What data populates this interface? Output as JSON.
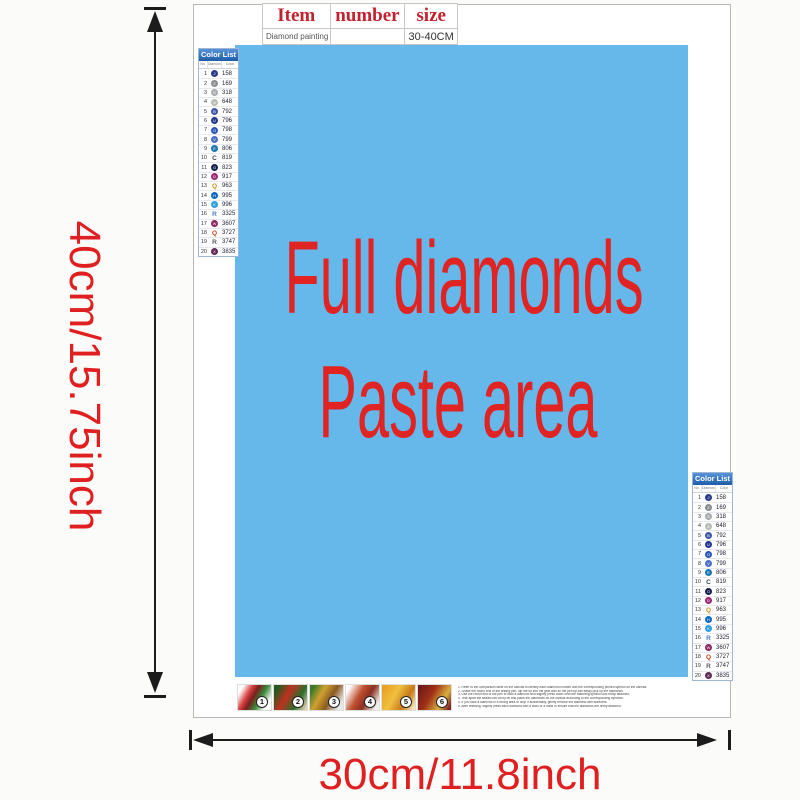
{
  "title_table": {
    "headers": [
      "Item",
      "number",
      "size"
    ],
    "item_value": "Diamond painting",
    "number_value": "",
    "size_value": "30-40CM"
  },
  "paste_area": {
    "line1": "Full diamonds",
    "line2": "Paste area",
    "bg_color": "#65b8e9",
    "text_color": "#e02424"
  },
  "dimensions": {
    "height_label": "40cm/15.75inch",
    "width_label": "30cm/11.8inch",
    "label_color": "#e01f20"
  },
  "color_list": {
    "title": "Color List",
    "columns": [
      "No.",
      "Diamond",
      "Color"
    ],
    "rows": [
      {
        "no": "1",
        "code": "158",
        "kind": "dot",
        "color": "#2b3c8f",
        "glyph": "J"
      },
      {
        "no": "2",
        "code": "169",
        "kind": "dot",
        "color": "#8a8d92",
        "glyph": "Z"
      },
      {
        "no": "3",
        "code": "318",
        "kind": "dot",
        "color": "#a7abb0",
        "glyph": "S"
      },
      {
        "no": "4",
        "code": "648",
        "kind": "dot",
        "color": "#b9bcb4",
        "glyph": "A"
      },
      {
        "no": "5",
        "code": "792",
        "kind": "dot",
        "color": "#3d55ad",
        "glyph": "B"
      },
      {
        "no": "6",
        "code": "796",
        "kind": "dot",
        "color": "#20368f",
        "glyph": "U"
      },
      {
        "no": "7",
        "code": "798",
        "kind": "dot",
        "color": "#2b56b8",
        "glyph": "O"
      },
      {
        "no": "8",
        "code": "799",
        "kind": "dot",
        "color": "#4a6fc4",
        "glyph": "V"
      },
      {
        "no": "9",
        "code": "806",
        "kind": "dot",
        "color": "#1776b4",
        "glyph": "E"
      },
      {
        "no": "10",
        "code": "819",
        "kind": "letter",
        "color": "#33415c",
        "glyph": "C"
      },
      {
        "no": "11",
        "code": "823",
        "kind": "dot",
        "color": "#141f4e",
        "glyph": "O"
      },
      {
        "no": "12",
        "code": "917",
        "kind": "dot",
        "color": "#9c2872",
        "glyph": "D"
      },
      {
        "no": "13",
        "code": "963",
        "kind": "letter",
        "color": "#d4891a",
        "glyph": "Q"
      },
      {
        "no": "14",
        "code": "995",
        "kind": "dot",
        "color": "#0b68c2",
        "glyph": "H"
      },
      {
        "no": "15",
        "code": "996",
        "kind": "dot",
        "color": "#2f9de0",
        "glyph": "K"
      },
      {
        "no": "16",
        "code": "3325",
        "kind": "letter",
        "color": "#4a7abf",
        "glyph": "R"
      },
      {
        "no": "17",
        "code": "3607",
        "kind": "dot",
        "color": "#8c2560",
        "glyph": "W"
      },
      {
        "no": "18",
        "code": "3727",
        "kind": "letter",
        "color": "#c2401a",
        "glyph": "Q"
      },
      {
        "no": "19",
        "code": "3747",
        "kind": "letter",
        "color": "#5a5a66",
        "glyph": "R"
      },
      {
        "no": "20",
        "code": "3835",
        "kind": "dot",
        "color": "#5f2a56",
        "glyph": "X"
      }
    ]
  },
  "steps": {
    "numbers": [
      "1",
      "2",
      "3",
      "4",
      "5",
      "6"
    ]
  },
  "instructions": [
    "Refer to the comparison table on the canvas to identify each diamond number and the corresponding printed symbol on the canvas.",
    "Shake the round end of the drilling pen, dip the tip into the glue wax so the pen tip can easily pick up the diamonds.",
    "Use the round end of the pen to stick a diamond and slightly press down onto the matching symbol until firmly attached.",
    "Tear apart the sealed film bit by bit and place the diamonds on the canvas according to the corresponding symbols.",
    "If you stick a diamond in a wrong area or drop it accidentally, gently remove the diamond with tweezers.",
    "After finishing, slightly press each diamond with a book or a hand to ensure that the diamonds are firmly attached."
  ]
}
